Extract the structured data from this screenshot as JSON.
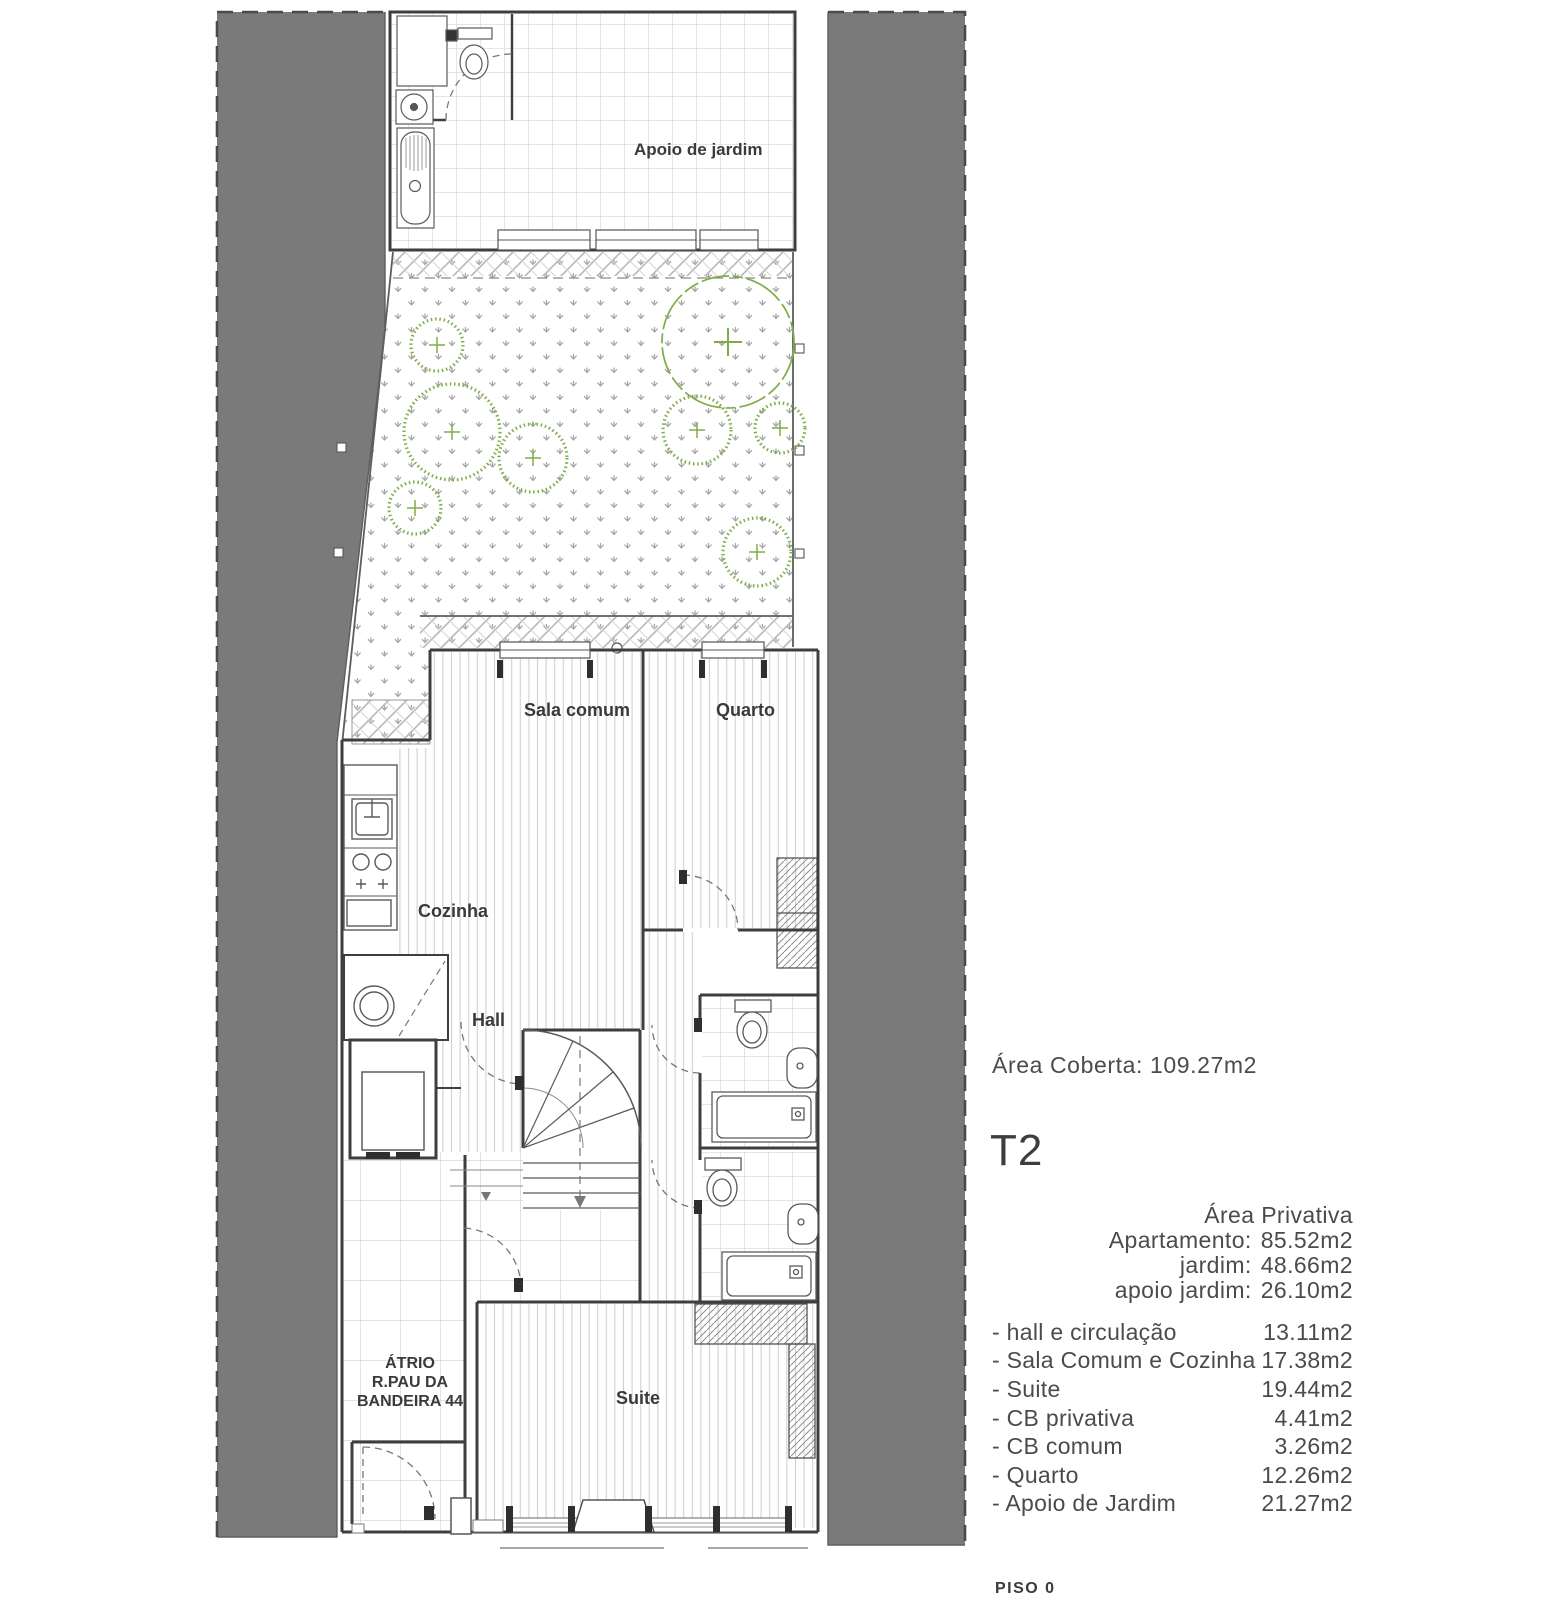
{
  "plan": {
    "labels": {
      "apoio_de_jardim": "Apoio de jardim",
      "sala_comum": "Sala comum",
      "quarto": "Quarto",
      "cozinha": "Cozinha",
      "hall": "Hall",
      "suite": "Suite",
      "atrio_line1": "ÁTRIO",
      "atrio_line2": "R.PAU DA",
      "atrio_line3": "BANDEIRA 44"
    },
    "colors": {
      "neighbor_mass": "#7a7a7a",
      "vegetation": "#7dad46",
      "linework": "#3e3e3e"
    }
  },
  "sidebar": {
    "area_coberta": "Área Coberta: 109.27m2",
    "unit_type": "T2",
    "private_areas": [
      {
        "label": "Área Privativa Apartamento:",
        "value": "85.52m2"
      },
      {
        "label": "jardim:",
        "value": "48.66m2"
      },
      {
        "label": "apoio jardim:",
        "value": "26.10m2"
      }
    ],
    "rooms": [
      {
        "label": "- hall e circulação",
        "value": "13.11m2"
      },
      {
        "label": "- Sala Comum e Cozinha",
        "value": "17.38m2"
      },
      {
        "label": "- Suite",
        "value": "19.44m2"
      },
      {
        "label": "- CB privativa",
        "value": "4.41m2"
      },
      {
        "label": "- CB comum",
        "value": "3.26m2"
      },
      {
        "label": "- Quarto",
        "value": "12.26m2"
      },
      {
        "label": "- Apoio de Jardim",
        "value": "21.27m2"
      }
    ],
    "floor_label": "PISO 0"
  }
}
